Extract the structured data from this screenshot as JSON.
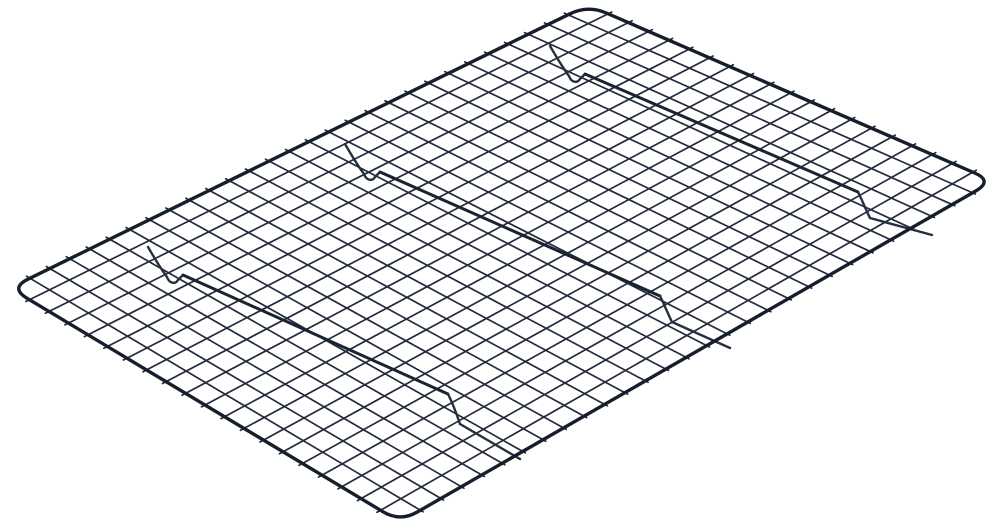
{
  "scene": {
    "type": "product-photo",
    "subject": "Black steel wire cooling rack shown at an angle on a plain white background",
    "background_color": "#ffffff"
  },
  "rack": {
    "colors": {
      "frame": "#171e2b",
      "grid_wire": "#232b3b",
      "support_bar": "#1b2332",
      "foot_wire": "#262e3f"
    },
    "outline": {
      "corner_north": [
        588,
        5
      ],
      "corner_east": [
        993,
        181
      ],
      "corner_south": [
        400,
        522
      ],
      "corner_west": [
        10,
        288
      ],
      "corner_radius": 20,
      "frame_stroke_width": 3.4
    },
    "grid": {
      "cells_short_side": 20,
      "cells_long_side": 29,
      "wire_stroke_width": 1.7,
      "tick_overhang_far": 4,
      "tick_overhang_near": 3
    },
    "support_bars": {
      "bar_stroke_width": 3,
      "foot_stroke_width": 2.4,
      "bars": [
        {
          "start": [
            585,
            74
          ],
          "end": [
            858,
            192
          ],
          "drop_to": [
            870,
            218
          ],
          "foot_tip": [
            932,
            235
          ]
        },
        {
          "start": [
            380,
            172
          ],
          "end": [
            660,
            296
          ],
          "drop_to": [
            672,
            322
          ],
          "foot_tip": [
            730,
            348
          ]
        },
        {
          "start": [
            183,
            275
          ],
          "end": [
            448,
            394
          ],
          "drop_to": [
            460,
            424
          ],
          "foot_tip": [
            520,
            459
          ]
        }
      ],
      "start_hook": {
        "rel_tip": [
          -35,
          -28
        ],
        "rel_c1": [
          -28,
          -16
        ],
        "rel_c2": [
          -22,
          -6
        ],
        "rel_mid": [
          -16,
          2
        ],
        "rel_c3": [
          -14,
          8
        ],
        "rel_c4": [
          -8,
          10
        ],
        "rel_join": [
          -5,
          5
        ]
      }
    }
  }
}
